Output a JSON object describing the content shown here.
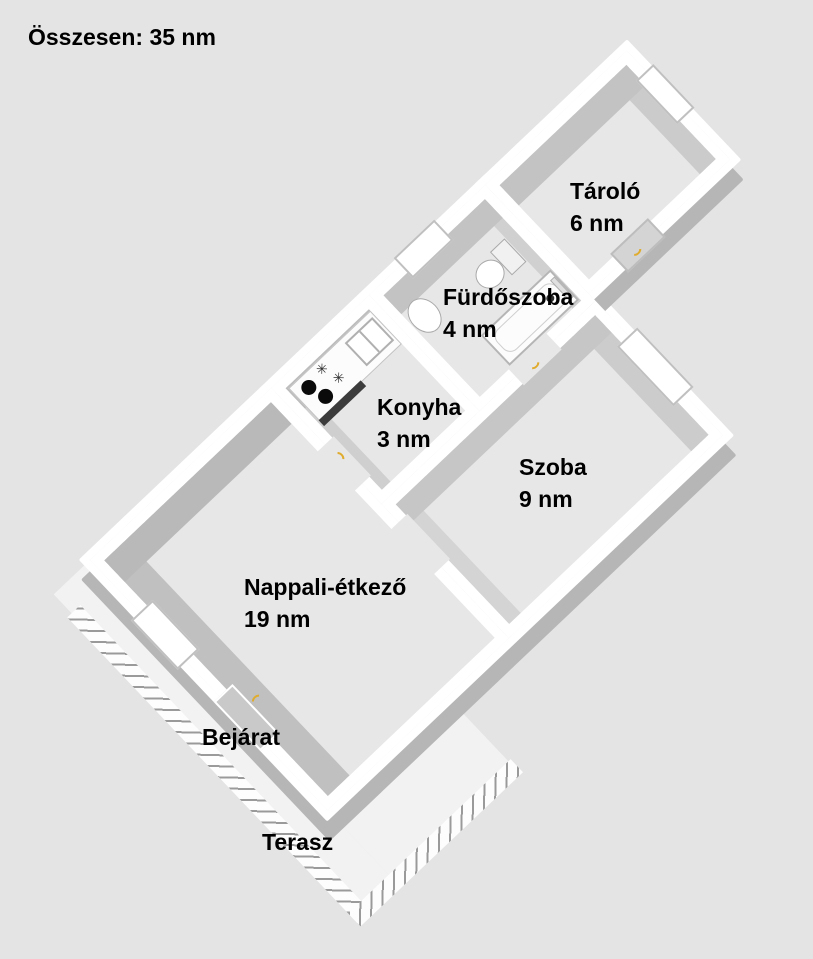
{
  "title": "Összesen: 35 nm",
  "watermark": {
    "logo": "OC",
    "line1": "OTTHON",
    "line2": "CENTRUM"
  },
  "rooms": [
    {
      "id": "tarolo",
      "name": "Tároló",
      "area": "6 nm"
    },
    {
      "id": "furdoszoba",
      "name": "Fürdőszoba",
      "area": "4 nm"
    },
    {
      "id": "konyha",
      "name": "Konyha",
      "area": "3 nm"
    },
    {
      "id": "szoba",
      "name": "Szoba",
      "area": "9 nm"
    },
    {
      "id": "nappali-etkezo",
      "name": "Nappali-étkező",
      "area": "19 nm"
    }
  ],
  "annotations": [
    {
      "id": "bejarat",
      "label": "Bejárat"
    },
    {
      "id": "terasz",
      "label": "Terasz"
    }
  ],
  "colors": {
    "background": "#e4e4e4",
    "floor": "#e7e7e7",
    "wall": "#ffffff",
    "wall_shade": "#c0c0c0",
    "outer_shade": "#b6b6b6",
    "terrace": "#f2f2f2",
    "door_accent": "#e0ac2f",
    "watermark_gray": "#9e9e9e",
    "label_text": "#000000"
  }
}
